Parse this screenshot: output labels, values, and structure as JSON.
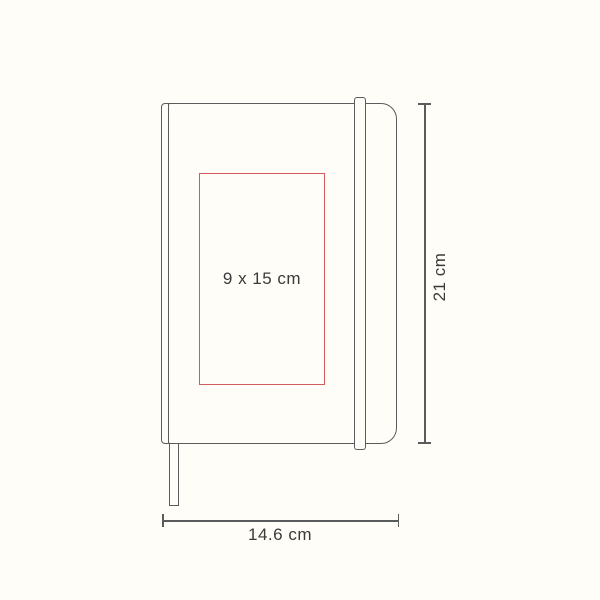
{
  "diagram": {
    "type": "product-dimension-diagram",
    "product": "hardcover notebook with elastic band and ribbon bookmark",
    "imprint_area": {
      "label": "9 x 15 cm"
    },
    "dimensions": {
      "height_label": "21 cm",
      "width_label": "14.6 cm"
    },
    "colors": {
      "background": "#fffdf7",
      "outline": "#5a5b5d",
      "imprint_outline": "#d15b5e",
      "label_text": "#3a3a3a"
    }
  }
}
